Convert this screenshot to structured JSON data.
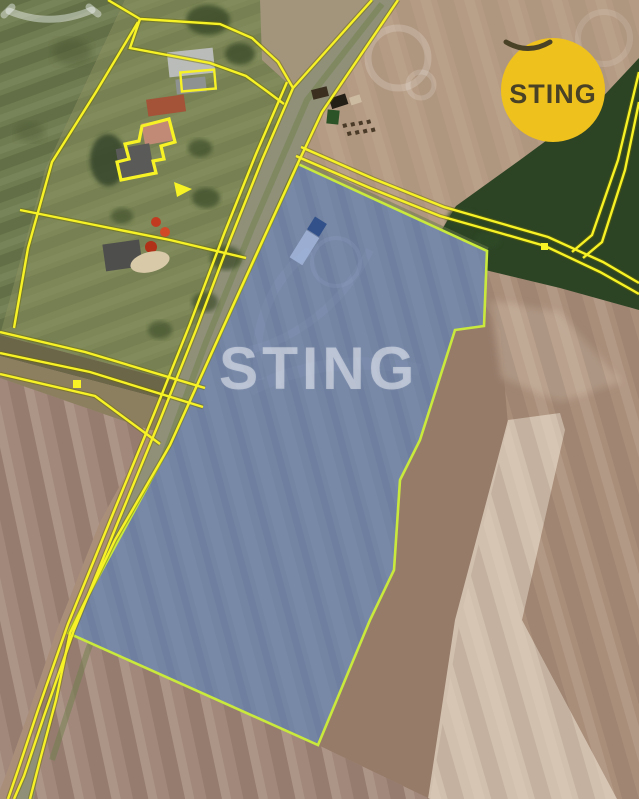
{
  "brand": {
    "name": "STING",
    "badge": {
      "text": "STING",
      "bg_color": "#eec11d",
      "fg_color": "#4a4226"
    },
    "watermark": {
      "text": "STING",
      "color": "rgba(250,252,255,0.45)"
    }
  },
  "map": {
    "description": "aerial cadastral photo with highlighted land parcel for sale",
    "parcel_highlight": {
      "fill": "rgba(78,112,182,0.5)",
      "stroke": "#c9e93c"
    },
    "cadastral_line_color": "#f7f226",
    "cadastral_line_casing": "#6d6a00"
  }
}
